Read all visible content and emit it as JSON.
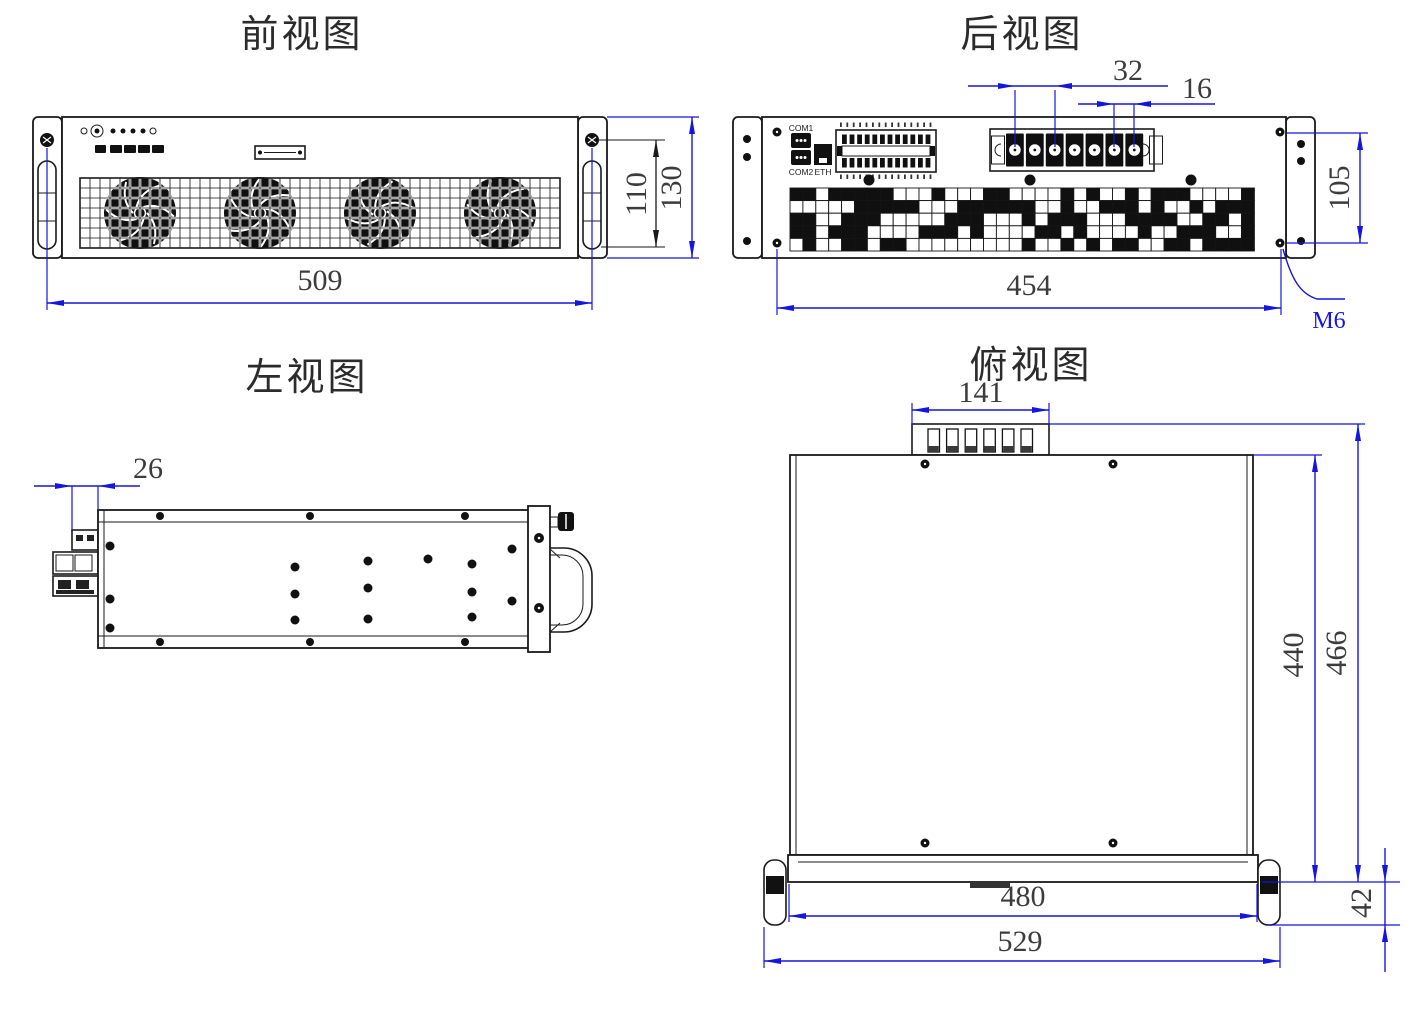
{
  "drawing": {
    "colors": {
      "dimension": "#1515dd",
      "object_line": "#1a1a1a",
      "dim_text": "#3c3c3c"
    },
    "views": {
      "front": {
        "title": "前视图",
        "dim_width": "509",
        "dim_hole_span": "110",
        "dim_height": "130"
      },
      "rear": {
        "title": "后视图",
        "dim_pitch2": "32",
        "dim_pitch1": "16",
        "dim_hole_span_h": "454",
        "dim_hole_span_v": "105",
        "screw_spec": "M6",
        "port_labels": {
          "com1": "COM1",
          "com2": "COM2",
          "eth": "ETH"
        }
      },
      "left": {
        "title": "左视图",
        "dim_protrusion": "26"
      },
      "top": {
        "title": "俯视图",
        "dim_connector": "141",
        "dim_body_depth": "440",
        "dim_overall_depth": "466",
        "dim_panel_width": "480",
        "dim_overall_width": "529",
        "dim_handle": "42"
      }
    }
  }
}
